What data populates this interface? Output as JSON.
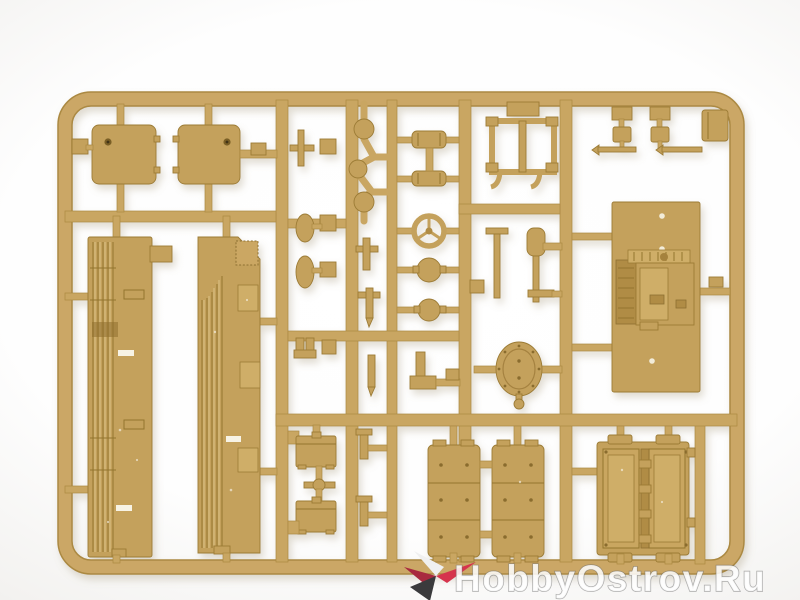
{
  "photo": {
    "description": "Top-down photograph of a sand-yellow injection-moulded plastic model-kit sprue (parts frame) lying on a white studio background",
    "background_color": "#ffffff",
    "vignette_color": "#e8e7e5",
    "plastic_colors": {
      "runner": "#c9a662",
      "part": "#c4a15c",
      "part_light": "#cfae67",
      "part_shadow": "#b08c45",
      "edge_dark": "#8d6f30"
    },
    "parts_visible": [
      "two square hatch plates (top left)",
      "two long ribbed hull-side panels (left)",
      "three-ball linkage sprig",
      "paired cylinders",
      "steering wheel",
      "two round knobs",
      "rack frame with hooks",
      "shovel and tool rods",
      "oval hatch with bolted rim and knob",
      "large engine plate with raised gearbox block (right)",
      "two stowage boxes",
      "two segmented belly/track panels (bottom centre)",
      "double hatch-door panel (bottom right)"
    ]
  },
  "watermark": {
    "text": "HobbyOstrov.Ru",
    "text_fill": "#ffffff",
    "text_outline": "#707070",
    "star": {
      "red": "#d6344d",
      "red_dark": "#a8293f",
      "dark": "#3a3a3c",
      "light": "#f0f0f0"
    }
  }
}
